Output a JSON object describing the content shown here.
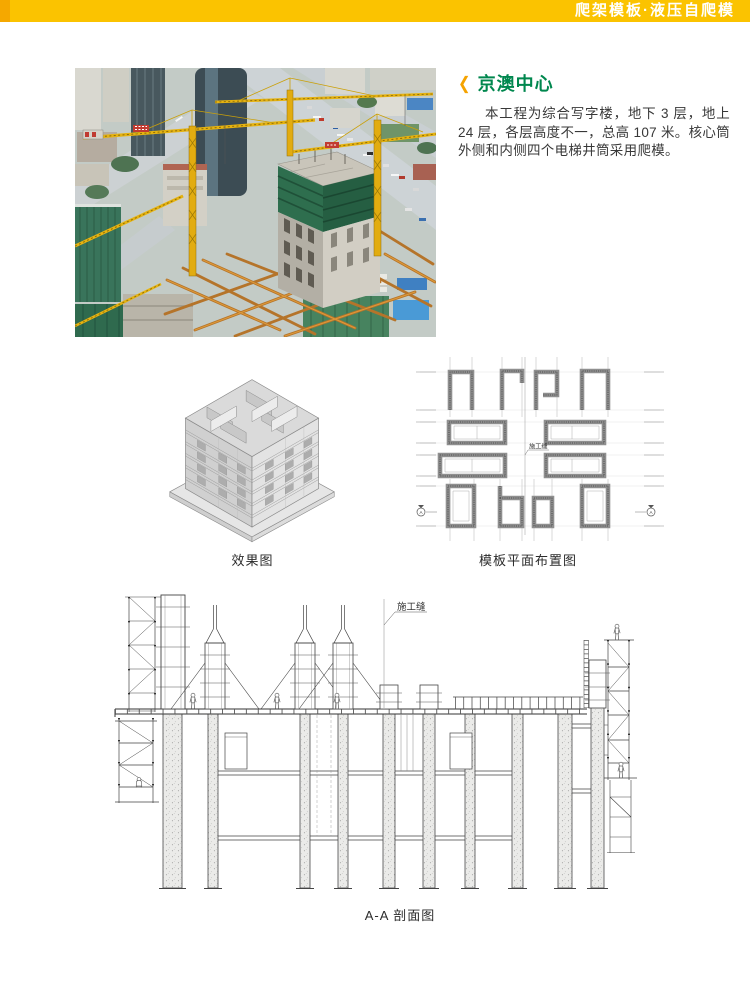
{
  "header": {
    "title": "爬架模板·液压自爬模"
  },
  "article": {
    "title": "京澳中心",
    "body": "本工程为综合写字楼，地下 3 层，地上 24 层，各层高度不一，总高 107 米。核心筒外侧和内侧四个电梯井筒采用爬模。"
  },
  "figures": {
    "effect": {
      "caption": "效果图"
    },
    "plan": {
      "caption": "模板平面布置图",
      "joint_label": "施工缝",
      "section_marker": "A"
    },
    "section": {
      "caption": "A-A 剖面图",
      "joint_label": "施工缝"
    }
  },
  "colors": {
    "header_bar": "#FBC300",
    "header_accent": "#F5A800",
    "title_green": "#00874E",
    "chevron_orange": "#F5A300",
    "crane_yellow": "#E6B310",
    "net_green": "#2E6E4E"
  }
}
